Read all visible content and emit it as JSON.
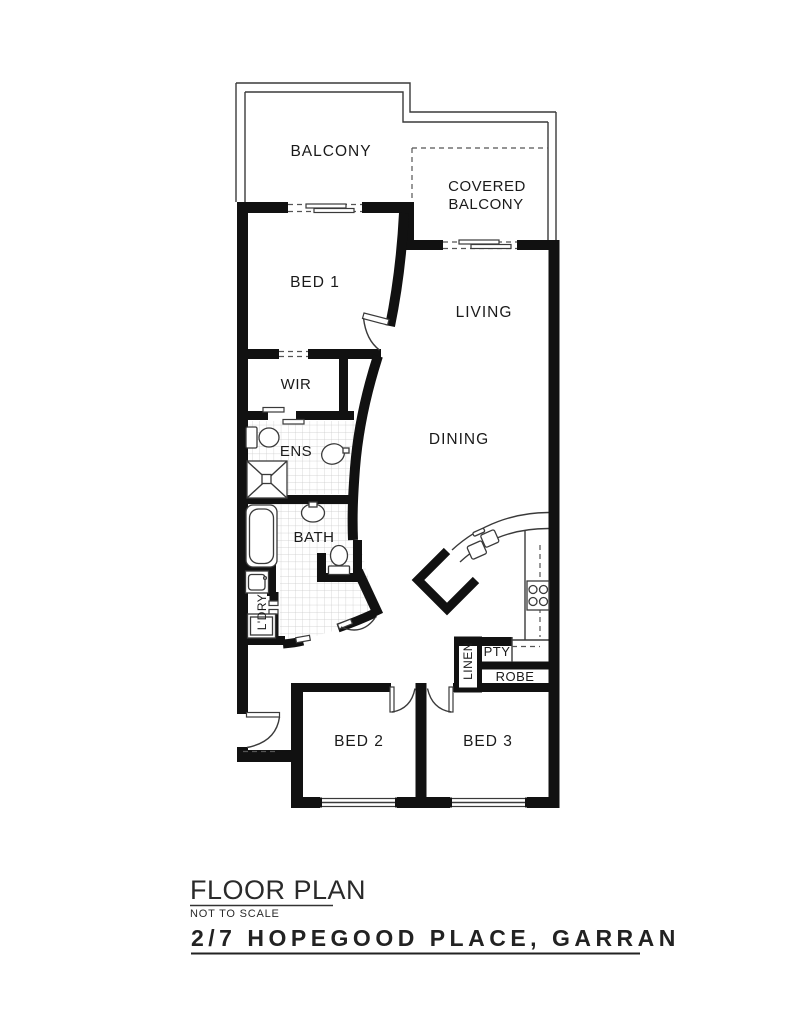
{
  "plan": {
    "rooms": {
      "balcony": "BALCONY",
      "covered_balcony_line1": "COVERED",
      "covered_balcony_line2": "BALCONY",
      "bed1": "BED 1",
      "living": "LIVING",
      "wir": "WIR",
      "ens": "ENS",
      "dining": "DINING",
      "bath": "BATH",
      "ldry": "L'DRY",
      "linen": "LINEN",
      "pty": "PTY",
      "robe": "ROBE",
      "bed2": "BED 2",
      "bed3": "BED 3"
    },
    "footer": {
      "title": "FLOOR PLAN",
      "scale_note": "NOT TO SCALE",
      "address": "2/7 HOPEGOOD PLACE, GARRAN"
    },
    "colors": {
      "wall": "#111111",
      "thin_line": "#3a3a3a",
      "dashed_line": "#555555",
      "tile_grid": "#c9c9c9",
      "background": "#ffffff"
    }
  }
}
